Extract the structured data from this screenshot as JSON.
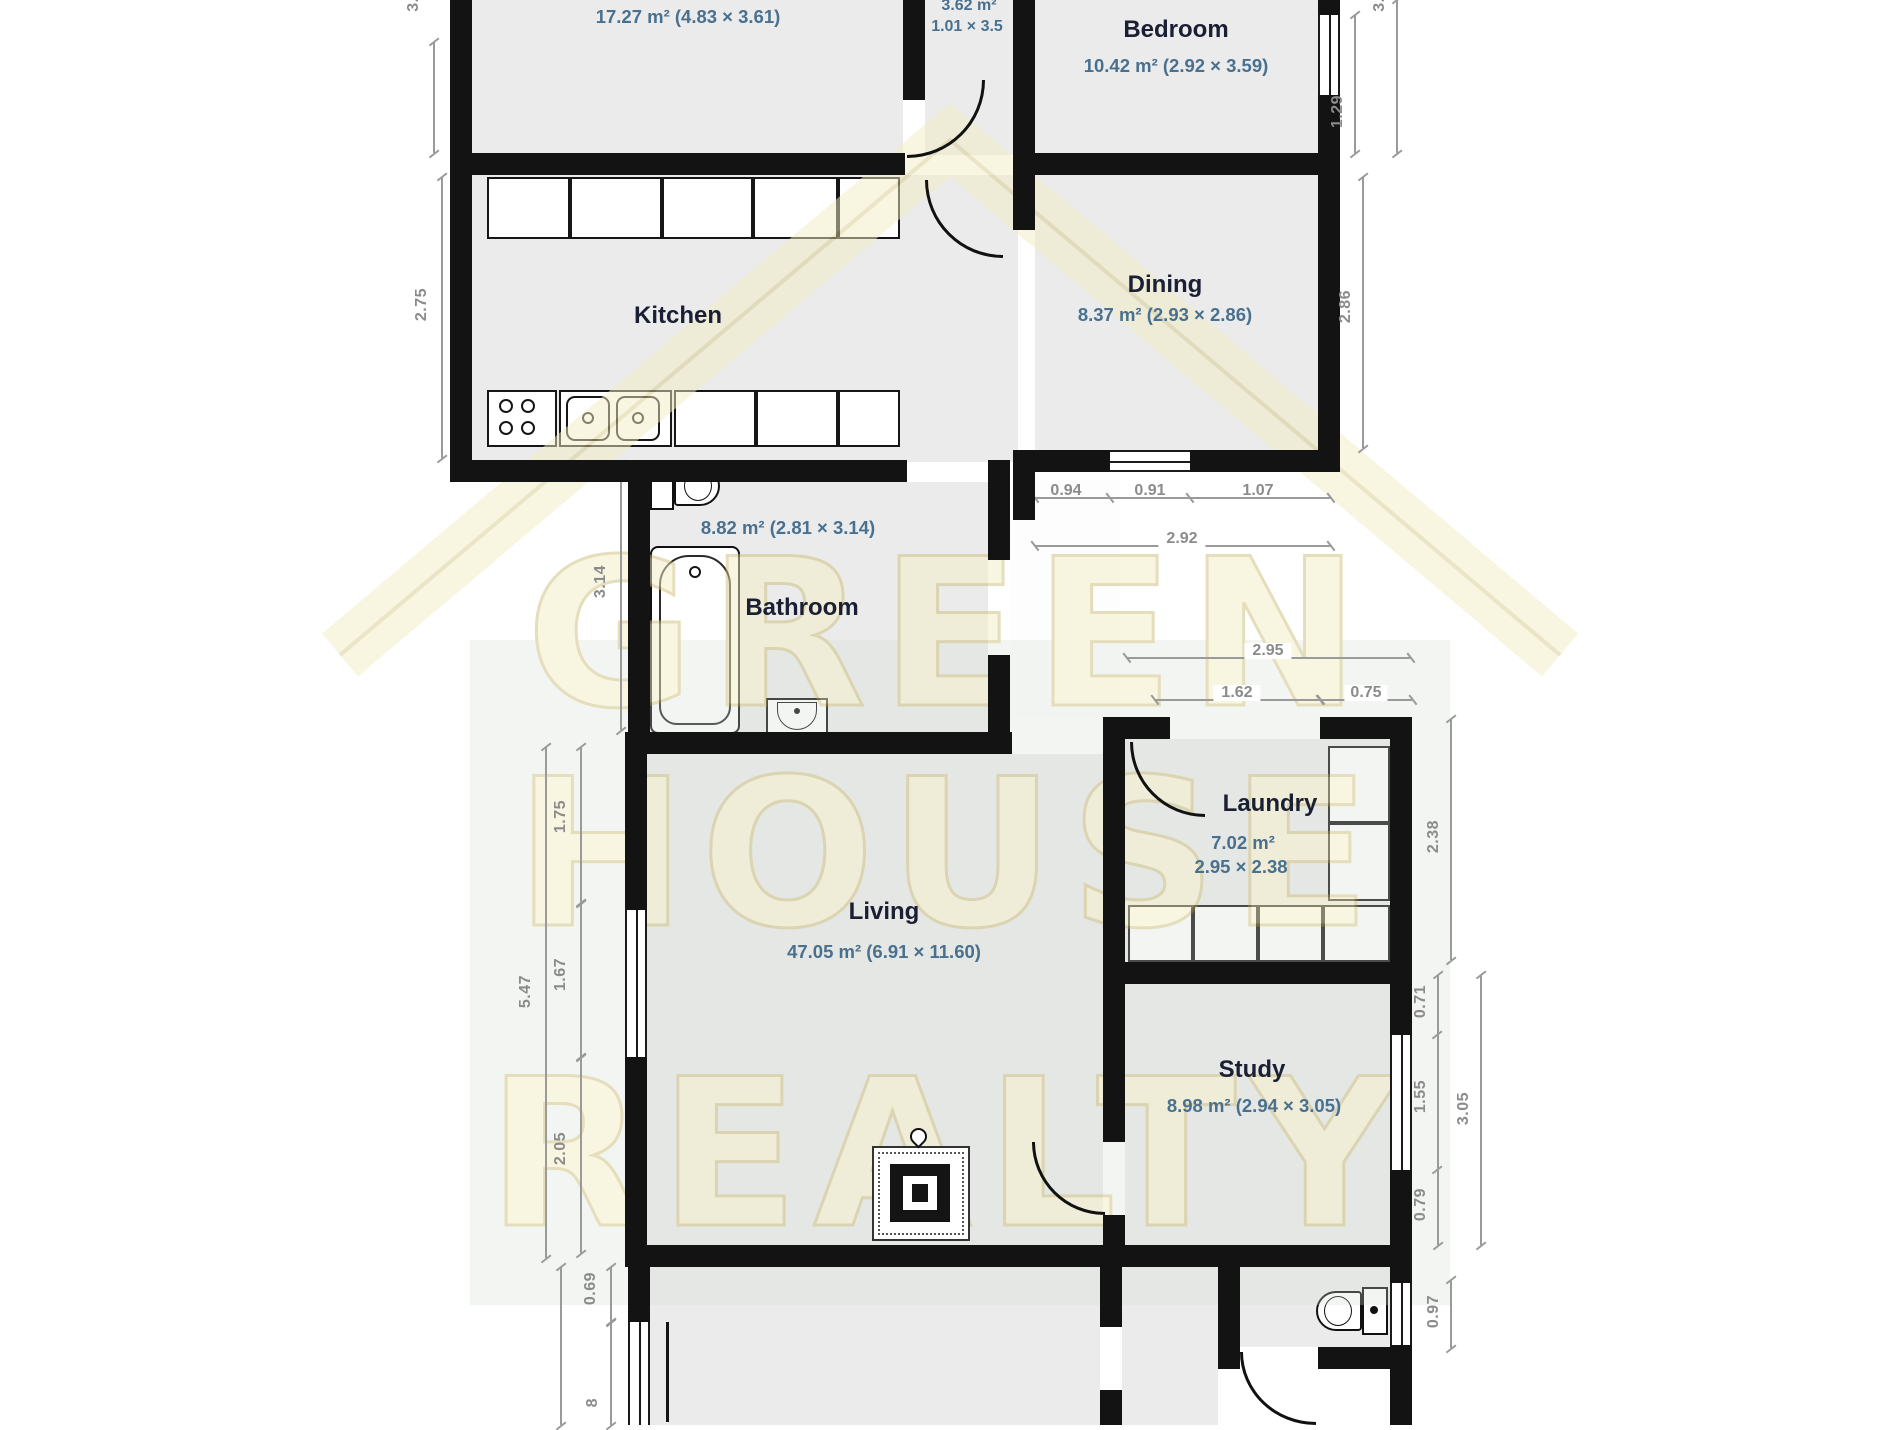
{
  "watermark": {
    "line1": "GREEN",
    "line2": "HOUSE",
    "line3": "REALTY"
  },
  "rooms": {
    "top_room": {
      "area": "17.27 m² (4.83 × 3.61)"
    },
    "hall": {
      "area": "3.62 m²",
      "dims": "1.01 × 3.5"
    },
    "bedroom": {
      "name": "Bedroom",
      "area": "10.42 m² (2.92 × 3.59)"
    },
    "kitchen": {
      "name": "Kitchen"
    },
    "dining": {
      "name": "Dining",
      "area": "8.37 m² (2.93 × 2.86)"
    },
    "bathroom": {
      "name": "Bathroom",
      "area": "8.82 m² (2.81 × 3.14)"
    },
    "living": {
      "name": "Living",
      "area": "47.05 m² (6.91 × 11.60)"
    },
    "laundry": {
      "name": "Laundry",
      "area": "7.02 m²",
      "dims": "2.95 × 2.38"
    },
    "study": {
      "name": "Study",
      "area": "8.98 m² (2.94 × 3.05)"
    }
  },
  "dims": {
    "top_left": "3.5",
    "kitchen_left": "2.75",
    "bathroom_left": "3.14",
    "living_left_total": "5.47",
    "living_left_1": "1.75",
    "living_left_2": "1.67",
    "living_left_3": "2.05",
    "bottom_left_1": "0.69",
    "bottom_left_2": "8",
    "bedroom_window": "1.29",
    "bedroom_right": "3.5",
    "dining_right": "2.86",
    "nook_1": "0.94",
    "nook_2": "0.91",
    "nook_3": "1.07",
    "nook_total": "2.92",
    "laundry_top_total": "2.95",
    "laundry_top_1": "1.62",
    "laundry_top_2": "0.75",
    "laundry_right": "2.38",
    "study_right_1": "0.71",
    "study_right_2": "1.55",
    "study_right_3": "0.79",
    "study_right_total": "3.05",
    "wc_right": "0.97"
  },
  "colors": {
    "wall": "#131313",
    "room_fill": "#ebebeb",
    "dimension": "#8b8b8b",
    "room_name": "#1a1f33",
    "room_area": "#49708f",
    "watermark_fill": "#f3edc4",
    "watermark_stroke": "#cdbf7b"
  }
}
